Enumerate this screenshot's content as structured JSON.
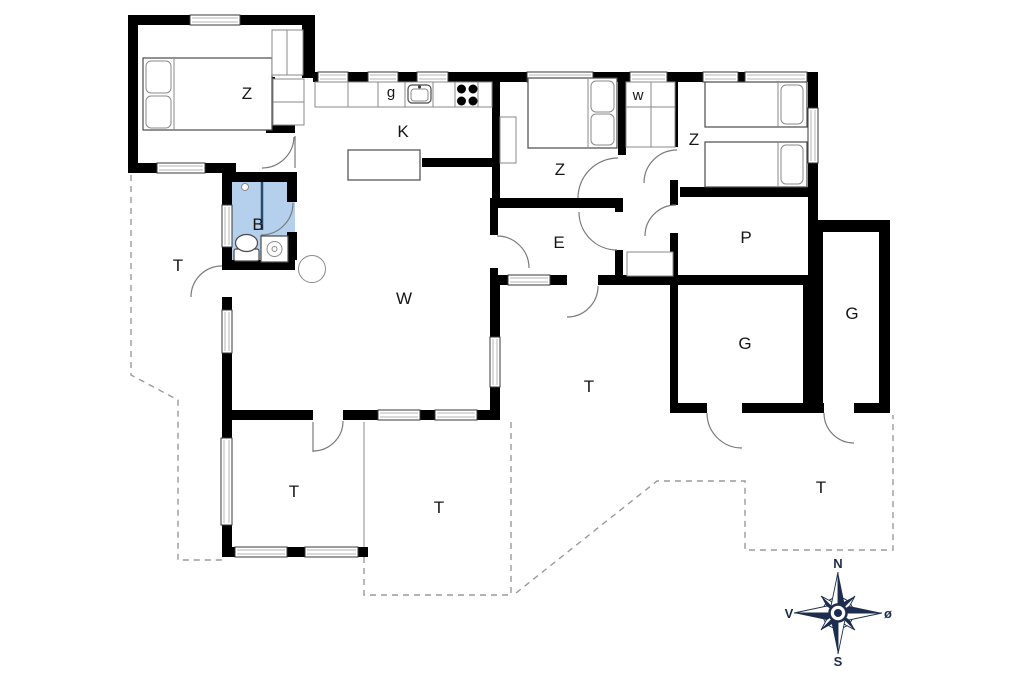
{
  "plan": {
    "rooms": {
      "bedroom1": "Z",
      "kitchen": "K",
      "fridge": "g",
      "bedroom2": "Z",
      "utility": "w",
      "bedroom3": "Z",
      "bathroom": "B",
      "entry": "E",
      "pantry": "P",
      "living": "W",
      "garage1": "G",
      "garage2": "G",
      "terrace_left": "T",
      "terrace_cons": "T",
      "terrace_mid": "T",
      "terrace_center": "T",
      "terrace_right": "T"
    },
    "compass": {
      "north": "N",
      "south": "S",
      "west": "V",
      "east": "ø"
    },
    "colors": {
      "wall": "#000000",
      "bathroom": "#b4d0ec",
      "compass": "#1c2d4d",
      "dashed_line": "#9a9a9a"
    }
  }
}
